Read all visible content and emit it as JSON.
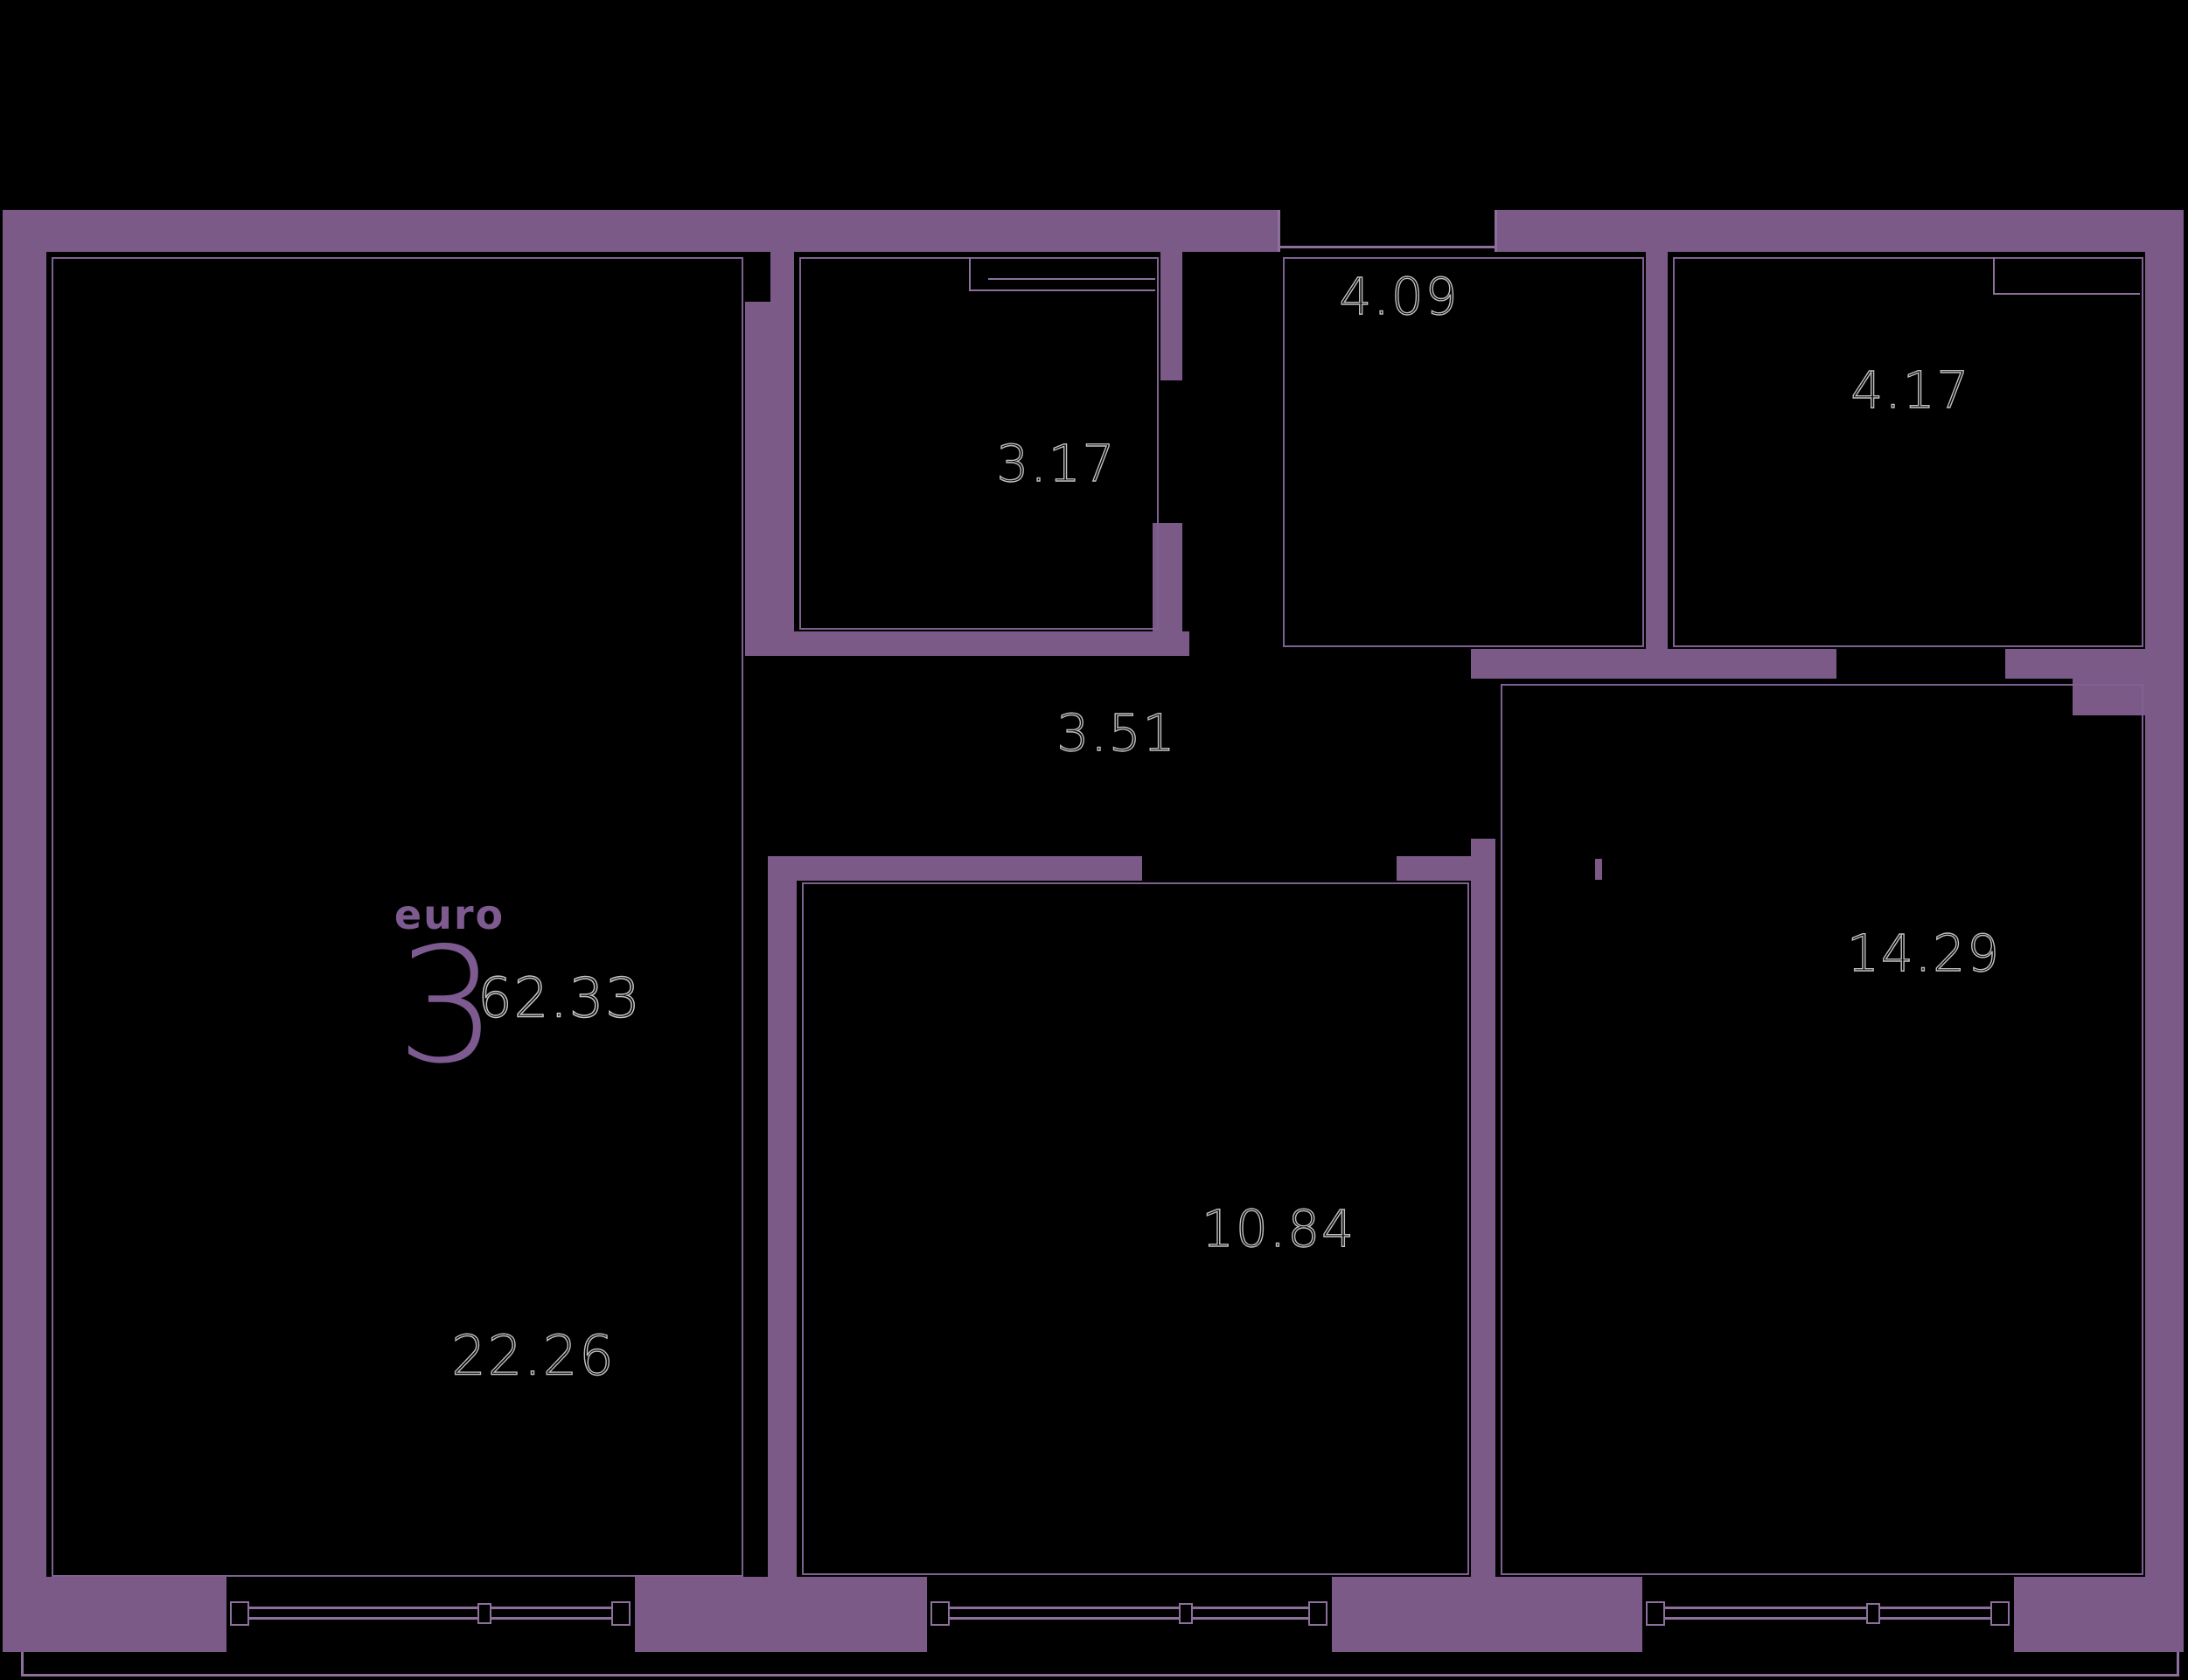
{
  "plan": {
    "unit_type_label": "euro",
    "unit_type_number": "3",
    "total_area": "62.33",
    "rooms": [
      {
        "name": "living-room",
        "area": "22.26"
      },
      {
        "name": "bathroom",
        "area": "3.17"
      },
      {
        "name": "entry-hall",
        "area": "4.09"
      },
      {
        "name": "bathroom-2",
        "area": "4.17"
      },
      {
        "name": "hallway",
        "area": "3.51"
      },
      {
        "name": "bedroom",
        "area": "10.84"
      },
      {
        "name": "bedroom-2",
        "area": "14.29"
      }
    ],
    "colors": {
      "background": "#000000",
      "wall": "#7b5a88",
      "thin_line": "#8d6f9c",
      "label_stroke": "#c0c0c0",
      "accent_text": "#7d5b90"
    }
  }
}
